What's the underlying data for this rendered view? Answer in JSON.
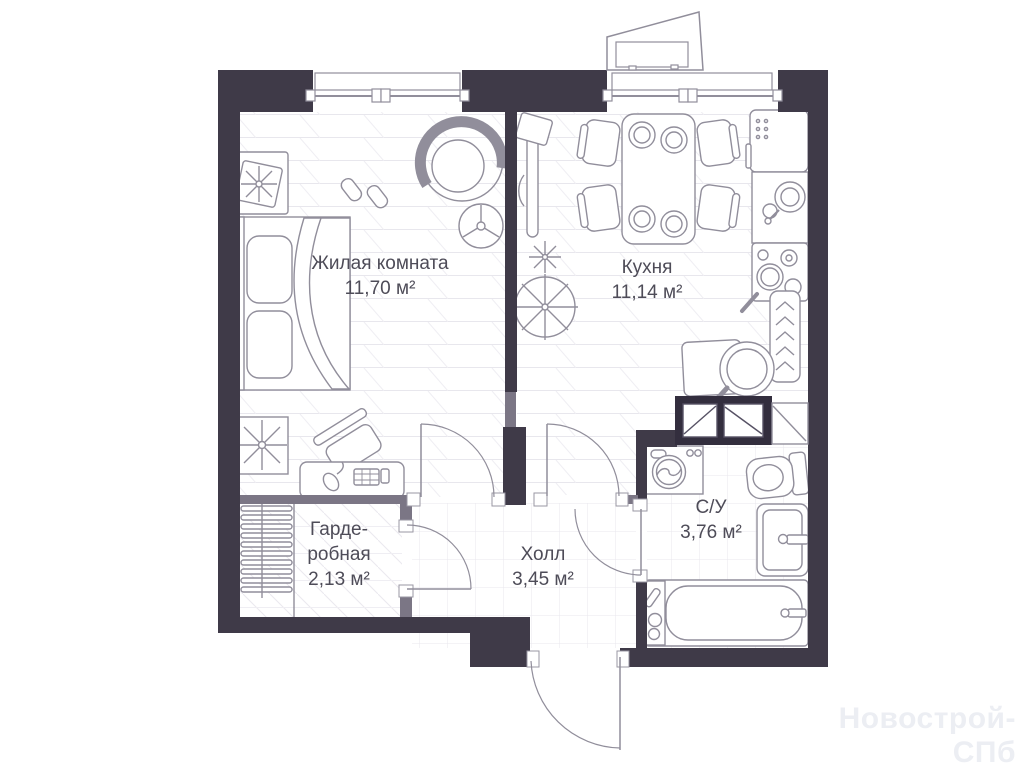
{
  "plan": {
    "title": "apartment-floor-plan",
    "rooms": [
      {
        "id": "living",
        "name": "Жилая комната",
        "area": "11,70 м²"
      },
      {
        "id": "kitchen",
        "name": "Кухня",
        "area": "11,14 м²"
      },
      {
        "id": "wardrobe",
        "name": "Гарде-\nробная",
        "area": "2,13 м²"
      },
      {
        "id": "hall",
        "name": "Холл",
        "area": "3,45 м²"
      },
      {
        "id": "bathroom",
        "name": "С/У",
        "area": "3,76 м²"
      }
    ],
    "watermark": "Новострой-СПб",
    "colors": {
      "bearing_wall": "#3f3a48",
      "partition_wall": "#7b7685",
      "furniture_stroke": "#918e9b",
      "floor_line": "#e8e7ed",
      "label_text": "#4e4c58",
      "watermark_text": "#eceef3"
    }
  }
}
